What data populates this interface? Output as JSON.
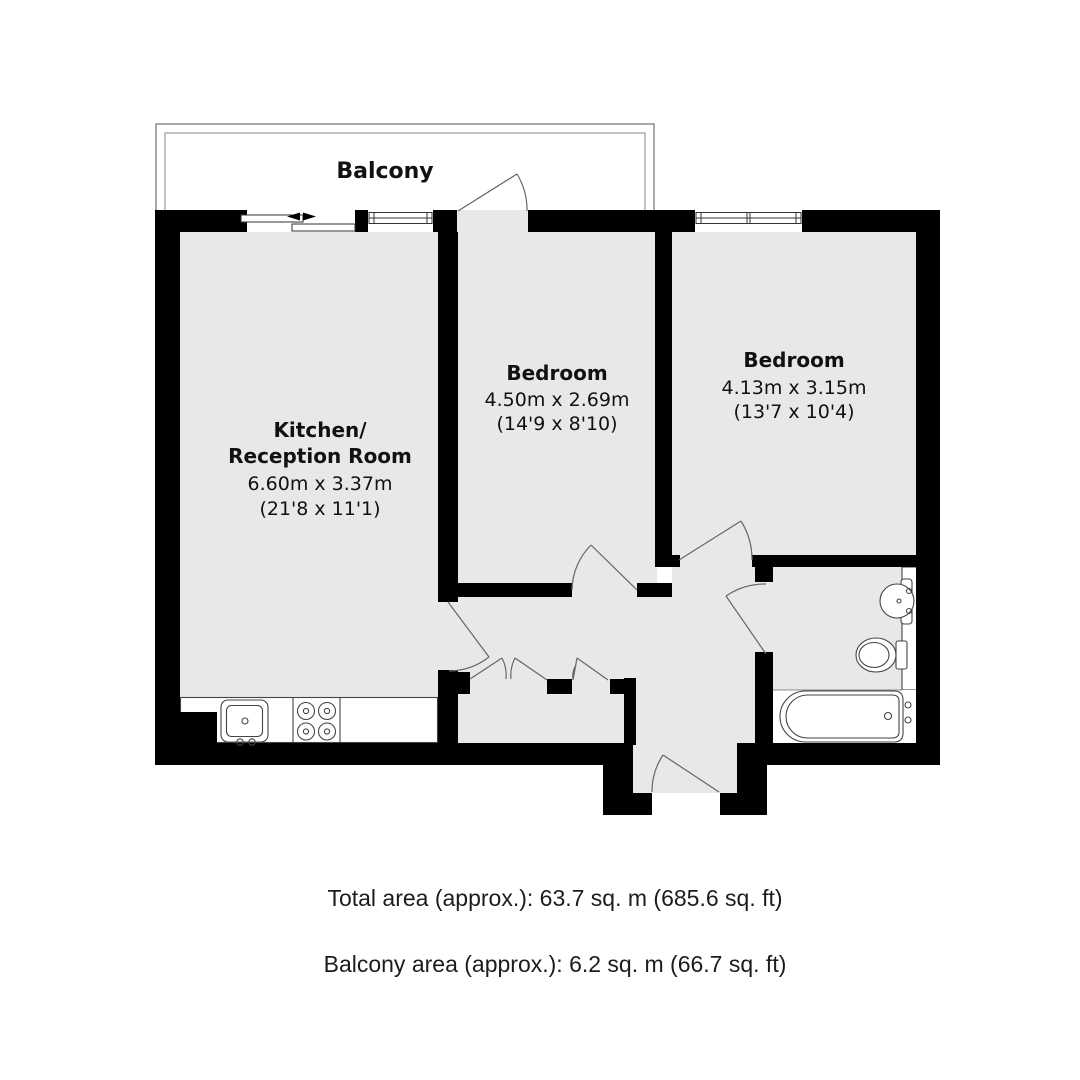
{
  "plan": {
    "balcony_label": "Balcony",
    "rooms": {
      "kitchen": {
        "name_line1": "Kitchen/",
        "name_line2": "Reception Room",
        "dims_metric": "6.60m x 3.37m",
        "dims_imperial": "(21'8 x 11'1)"
      },
      "bedroom_middle": {
        "name": "Bedroom",
        "dims_metric": "4.50m x 2.69m",
        "dims_imperial": "(14'9 x 8'10)"
      },
      "bedroom_right": {
        "name": "Bedroom",
        "dims_metric": "4.13m x 3.15m",
        "dims_imperial": "(13'7 x 10'4)"
      }
    },
    "fixture_icons": [
      "kitchen-sink-icon",
      "stove-icon",
      "wash-basin-icon",
      "toilet-icon",
      "bathtub-icon",
      "sliding-door-icon",
      "window-icon",
      "door-swing-icon"
    ],
    "colors": {
      "wall": "#000000",
      "floor": "#e8e8e8",
      "outline": "#666666",
      "balcony_outline": "#8c8c8c",
      "text": "#111111"
    }
  },
  "summary": {
    "total_area": "Total area (approx.): 63.7 sq. m (685.6 sq. ft)",
    "balcony_area": "Balcony area (approx.): 6.2 sq. m (66.7 sq. ft)"
  }
}
